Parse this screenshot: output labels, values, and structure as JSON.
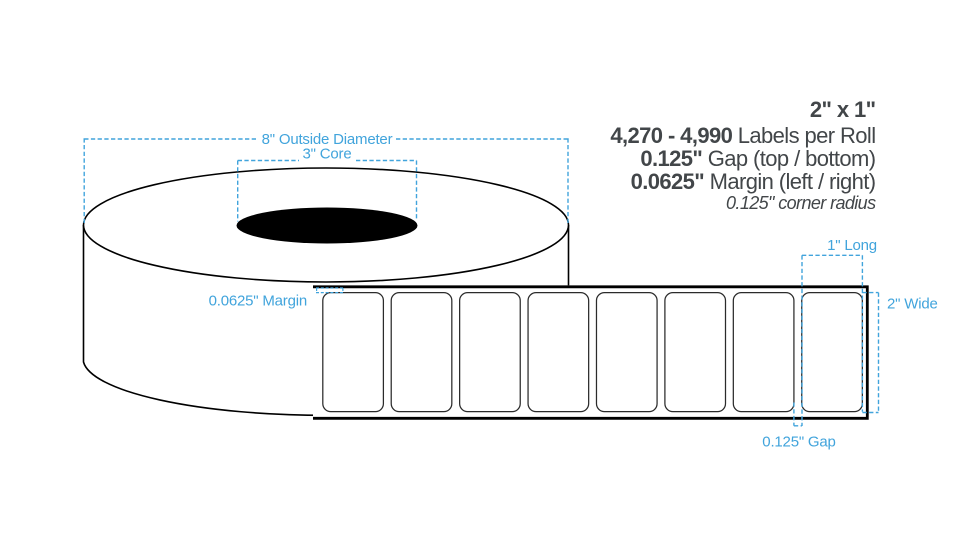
{
  "colors": {
    "accent_blue": "#41A4DC",
    "text_dark": "#424649",
    "line_black": "#000000",
    "label_stroke": "#2B2B2B"
  },
  "specs": {
    "size": "2\" x 1\"",
    "labels_per_roll_value": "4,270 - 4,990",
    "labels_per_roll_label": " Labels per Roll",
    "gap_value": "0.125\"",
    "gap_label": " Gap (top / bottom)",
    "margin_value": "0.0625\"",
    "margin_label": " Margin (left / right)",
    "corner_radius": "0.125\" corner radius"
  },
  "dimension_labels": {
    "outside_diameter": "8\" Outside Diameter",
    "core": "3\" Core",
    "margin": "0.0625\" Margin",
    "label_long": "1\" Long",
    "label_wide": "2\" Wide",
    "gap": "0.125\" Gap"
  },
  "diagram": {
    "label_count": 8
  }
}
